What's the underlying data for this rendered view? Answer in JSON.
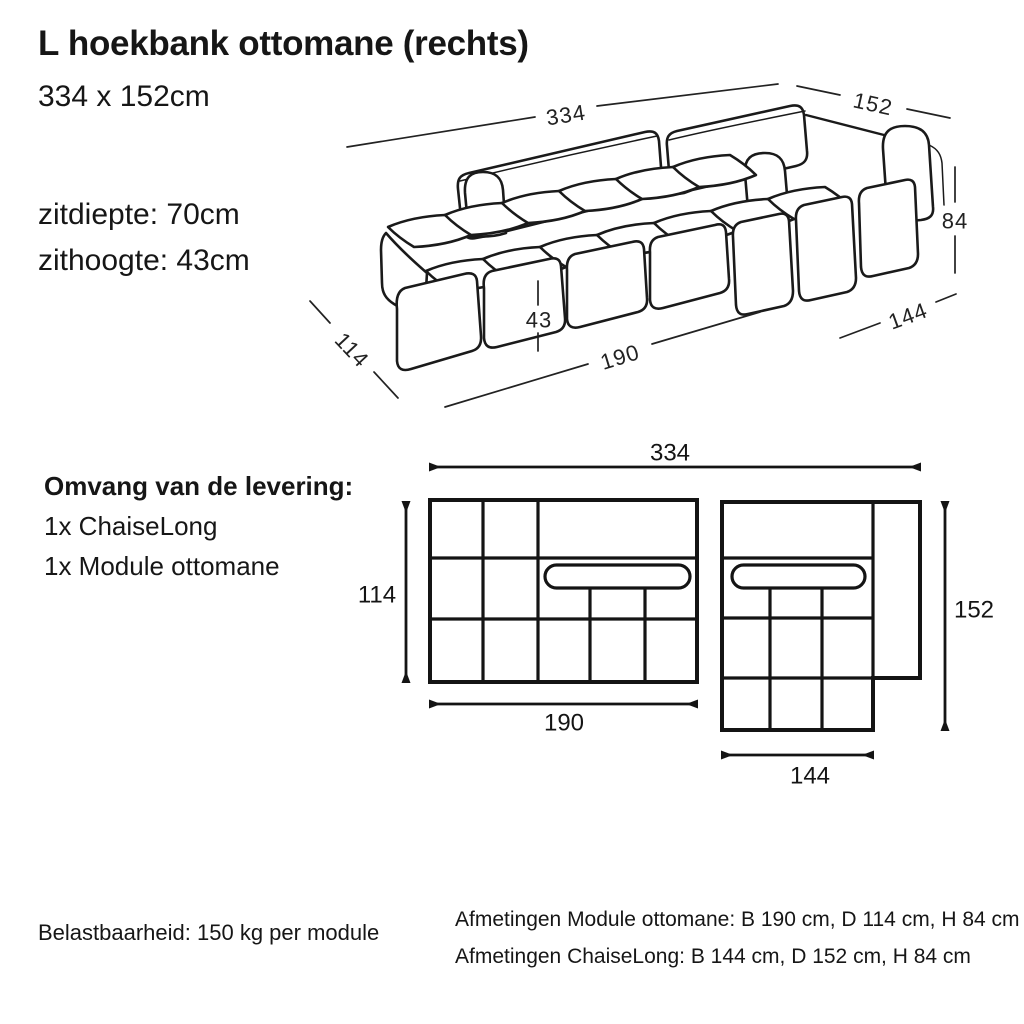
{
  "page": {
    "background": "#ffffff",
    "line_color": "#1a1a1a"
  },
  "header": {
    "title": "L hoekbank ottomane (rechts)",
    "dimensions": "334 x 152cm"
  },
  "specs": {
    "seat_depth": "zitdiepte: 70cm",
    "seat_height": "zithoogte: 43cm"
  },
  "delivery": {
    "heading": "Omvang van de levering:",
    "items": [
      "1x ChaiseLong",
      "1x Module ottomane"
    ]
  },
  "illustration": {
    "dim_total_width": "334",
    "dim_total_depth": "152",
    "dim_height": "84",
    "dim_chaise_width": "144",
    "dim_module_width": "190",
    "dim_seat_height": "43",
    "dim_module_depth": "114"
  },
  "schematic": {
    "dim_total_width": "334",
    "dim_module_depth": "114",
    "dim_module_width": "190",
    "dim_chaise_depth": "152",
    "dim_chaise_width": "144"
  },
  "footer": {
    "load_capacity": "Belastbaarheid: 150 kg per module",
    "module_dimensions": "Afmetingen Module ottomane: B 190 cm, D 114 cm, H 84 cm",
    "chaise_dimensions": "Afmetingen ChaiseLong: B 144 cm, D 152 cm, H 84 cm"
  }
}
